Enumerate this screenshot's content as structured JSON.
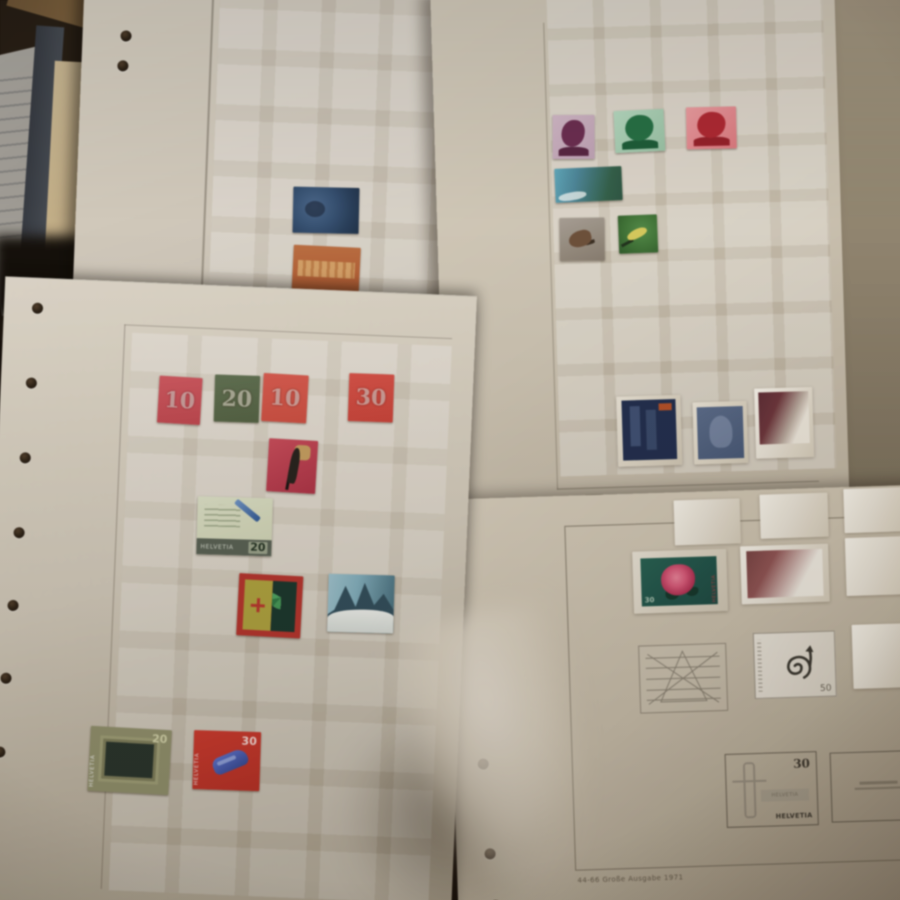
{
  "scene": {
    "type": "photograph",
    "description": "Overhead photo of four cream stamp-album pages with mounted Helvetia (Swiss) postage stamps, binder holes along page edges, pre-printed mount grids, dim warm lighting, blurred finger at bottom center",
    "caption": "44-66 Große Ausgabe 1971"
  },
  "colors": {
    "page_cream": "#d3cab9",
    "background_dark": "#241a10",
    "numeral_red": "#d6545c",
    "numeral_green": "#5e704e",
    "stamp_blue": "#335074",
    "stamp_orange": "#b85e30",
    "rose_pink": "#e05578",
    "whistle_red": "#da3629"
  },
  "icons": {
    "spiral": "spiral-arrow sketch with value 50",
    "geometric": "crossed-lines star sketch",
    "figure": "statue-with-cross outline"
  },
  "stamps": {
    "numeral_10_red": {
      "value": "10"
    },
    "numeral_20_green": {
      "value": "20"
    },
    "numeral_10_orange": {
      "value": "10"
    },
    "numeral_30_red": {
      "value": "30"
    },
    "pen_letter": {
      "country": "HELVETIA",
      "value": "20"
    },
    "stadium": {
      "country": "HELVETIA",
      "value": "20"
    },
    "whistle": {
      "country": "HELVETIA",
      "value": "30"
    },
    "rose": {
      "country": "HELVETIA",
      "value": "30"
    },
    "spiral_placeholder": {
      "value": "50"
    },
    "printed_placeholder": {
      "value": "30",
      "country": "HELVETIA",
      "label": "HELVETIA"
    }
  }
}
